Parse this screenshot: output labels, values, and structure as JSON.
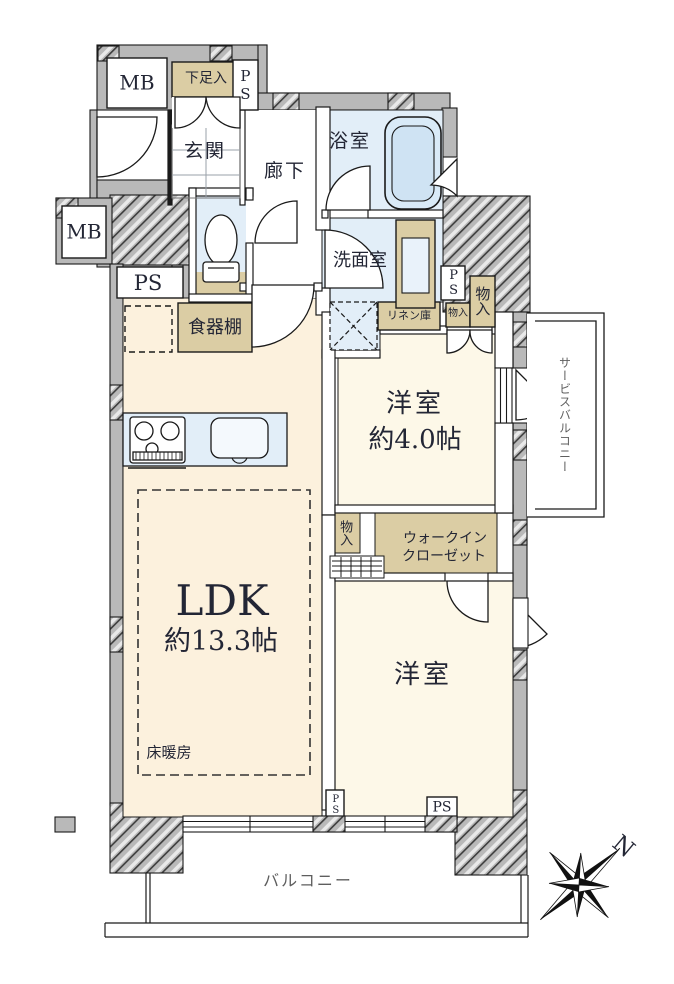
{
  "plan_type": "apartment-floorplan",
  "rooms": {
    "ldk": {
      "name": "LDK",
      "size": "約13.3帖",
      "floor_heating": "床暖房"
    },
    "bedroom1": {
      "name": "洋室",
      "size": "約4.0帖"
    },
    "bedroom2": {
      "name": "洋室"
    },
    "entrance": {
      "name": "玄関"
    },
    "corridor": {
      "name": "廊下"
    },
    "bath": {
      "name": "浴室"
    },
    "washroom": {
      "name": "洗面室"
    },
    "balcony": {
      "name": "バルコニー"
    },
    "service_balcony": {
      "name": "サービスバルコニー"
    },
    "wic": {
      "line1": "ウォークイン",
      "line2": "クローゼット"
    }
  },
  "storage": {
    "shoe_cabinet": "下足入",
    "dish_cabinet": "食器棚",
    "linen": "リネン庫",
    "closet_small": "物入",
    "closet_tall": "物入",
    "closet_mid": "物入"
  },
  "service_boxes": {
    "mb_top": "MB",
    "mb_left": "MB",
    "ps_top": "PS",
    "ps_left": "PS",
    "ps_right": "PS",
    "ps_bottom_left": "PS",
    "ps_bottom_right": "PS"
  },
  "compass": {
    "north": "N"
  },
  "palette": {
    "room_cream": "#fcf1dd",
    "room_cream_light": "#fdf8e8",
    "wet_area_blue": "#e2eef8",
    "tub_blue": "#cfe3f3",
    "storage_tan": "#dbcda4",
    "wall_gray": "#b9b9b9",
    "line_black": "#1a1a1a",
    "label_dark": "#232635",
    "label_gray": "#5e5e5e"
  }
}
